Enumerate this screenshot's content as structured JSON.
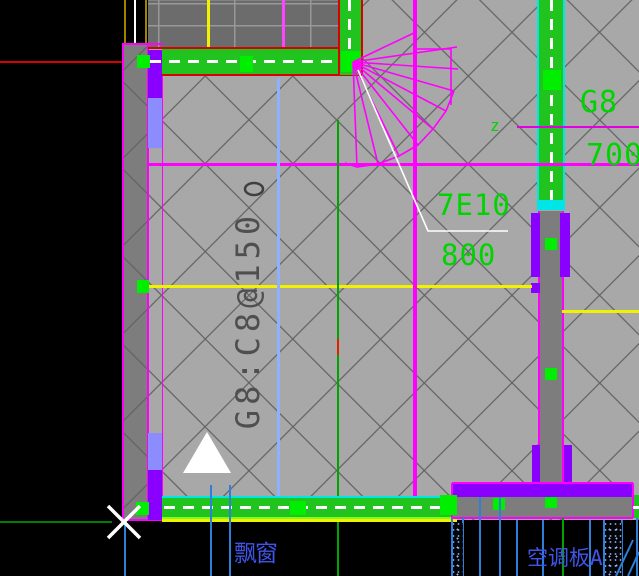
{
  "drawing": {
    "labels": {
      "wall_mark": "G8",
      "wall_dim": "700",
      "rebar_count": "7E10",
      "rebar_spacing": "800",
      "slab_rebar": "G8:C8@150",
      "break_symbol": "z",
      "bay_window": "飘窗",
      "ac_slab": "空调板A"
    },
    "colors": {
      "background": "#000000",
      "slab_gray": "#a8a8a8",
      "upper_room_gray": "#6c6c6c",
      "wall_gray": "#7d7d7d",
      "wall_green": "#21c41e",
      "column_green": "#00ee00",
      "rebar_purple": "#8a00ff",
      "rebar_periwinkle": "#8c8cff",
      "outline_magenta": "#ff00ff",
      "outline_red": "#d90000",
      "rebar_yellow": "#f2f200",
      "cap_cyan": "#00e5e5",
      "annotation_green_text": "#00d400",
      "annotation_blue_text": "#3f55e8",
      "slab_text_gray": "#4f4f4f",
      "aux_blue_line": "#2d7fd8",
      "aux_lightblue_line": "#8fb0ff",
      "aux_green_line": "#00a300"
    }
  }
}
